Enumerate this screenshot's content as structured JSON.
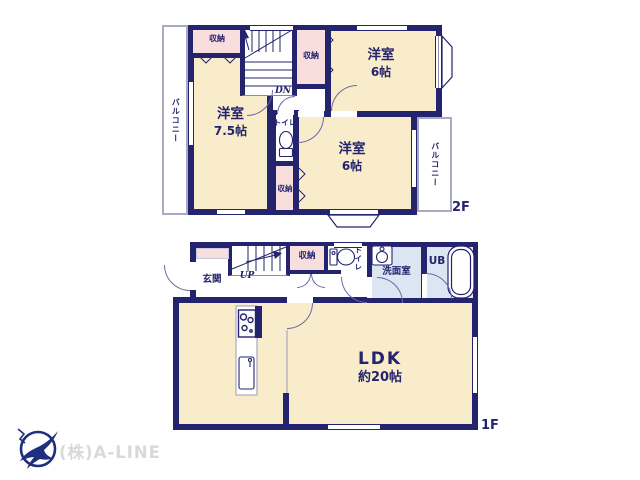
{
  "floor2": {
    "label": "2F",
    "balcony_left": "バルコニー",
    "balcony_right": "バルコニー",
    "closet_top": "収納",
    "closet_mid": "収納",
    "closet_bottom": "収納",
    "toilet": "トイレ",
    "stairs": "DN",
    "room_a": {
      "name": "洋室",
      "size": "7.5帖"
    },
    "room_b": {
      "name": "洋室",
      "size": "6帖"
    },
    "room_c": {
      "name": "洋室",
      "size": "6帖"
    }
  },
  "floor1": {
    "label": "1F",
    "entrance": "玄関",
    "stairs": "UP",
    "closet": "収納",
    "toilet": "トイレ",
    "washroom": "洗面室",
    "bath": "UB",
    "ldk": {
      "name": "LDK",
      "size": "約20帖"
    }
  },
  "footer": {
    "company": "(株)A-LINE"
  },
  "colors": {
    "wall": "#23236e",
    "room": "#f8ecca",
    "closet": "#f9dede",
    "wet": "#dce6f2",
    "balcony_border": "#a9a9c4",
    "logo": "#1e2f7d"
  }
}
